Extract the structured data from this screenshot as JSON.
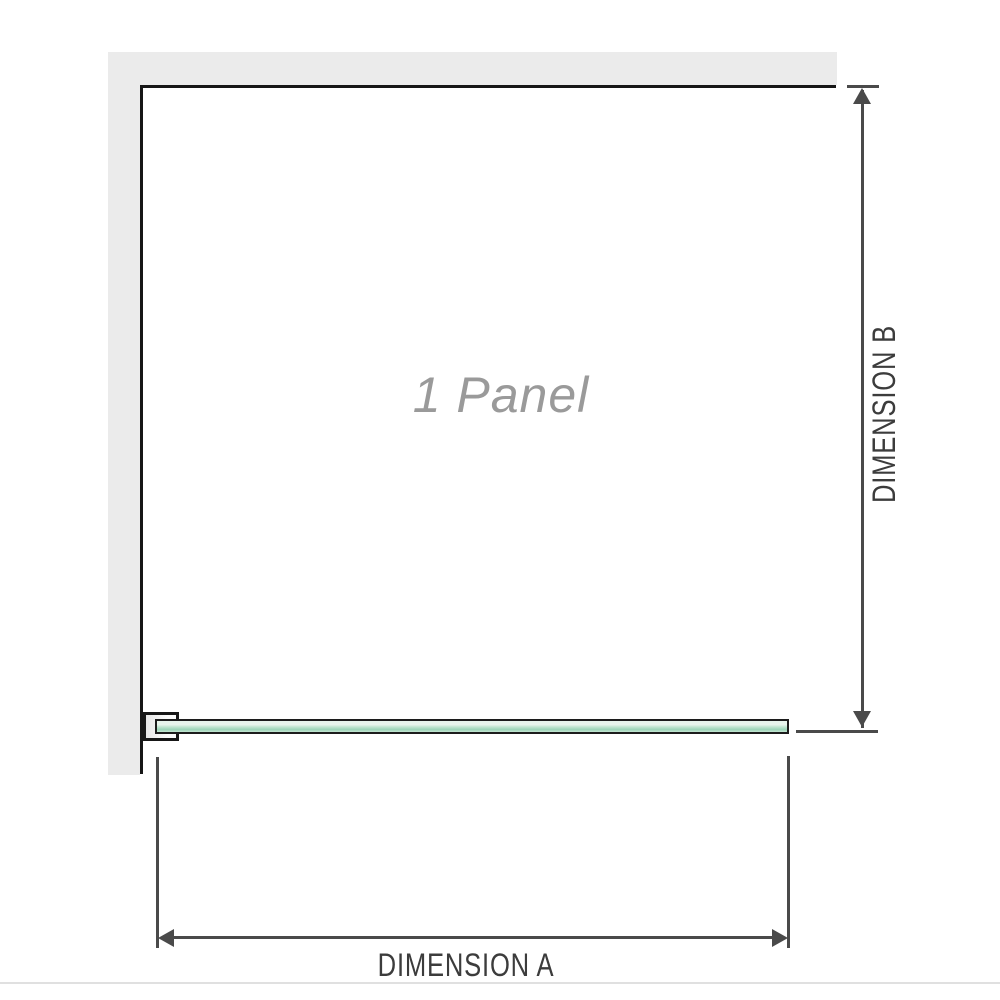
{
  "diagram": {
    "panel_label": "1 Panel",
    "dimension_a": {
      "label": "DIMENSION A"
    },
    "dimension_b": {
      "label": "DIMENSION B"
    }
  },
  "colors": {
    "background": "#ffffff",
    "wall": "#ebebeb",
    "outline": "#161616",
    "glass_border": "#1c1c1c",
    "glass_light": "#e7f4ec",
    "glass_mid": "#c4e6d3",
    "glass_dark": "#9bd5b7",
    "panel_label_text": "#9a9a9a",
    "dimension_line": "#4a4a4a",
    "dimension_text": "#3c3c3c",
    "divider": "#e0e0e0"
  }
}
